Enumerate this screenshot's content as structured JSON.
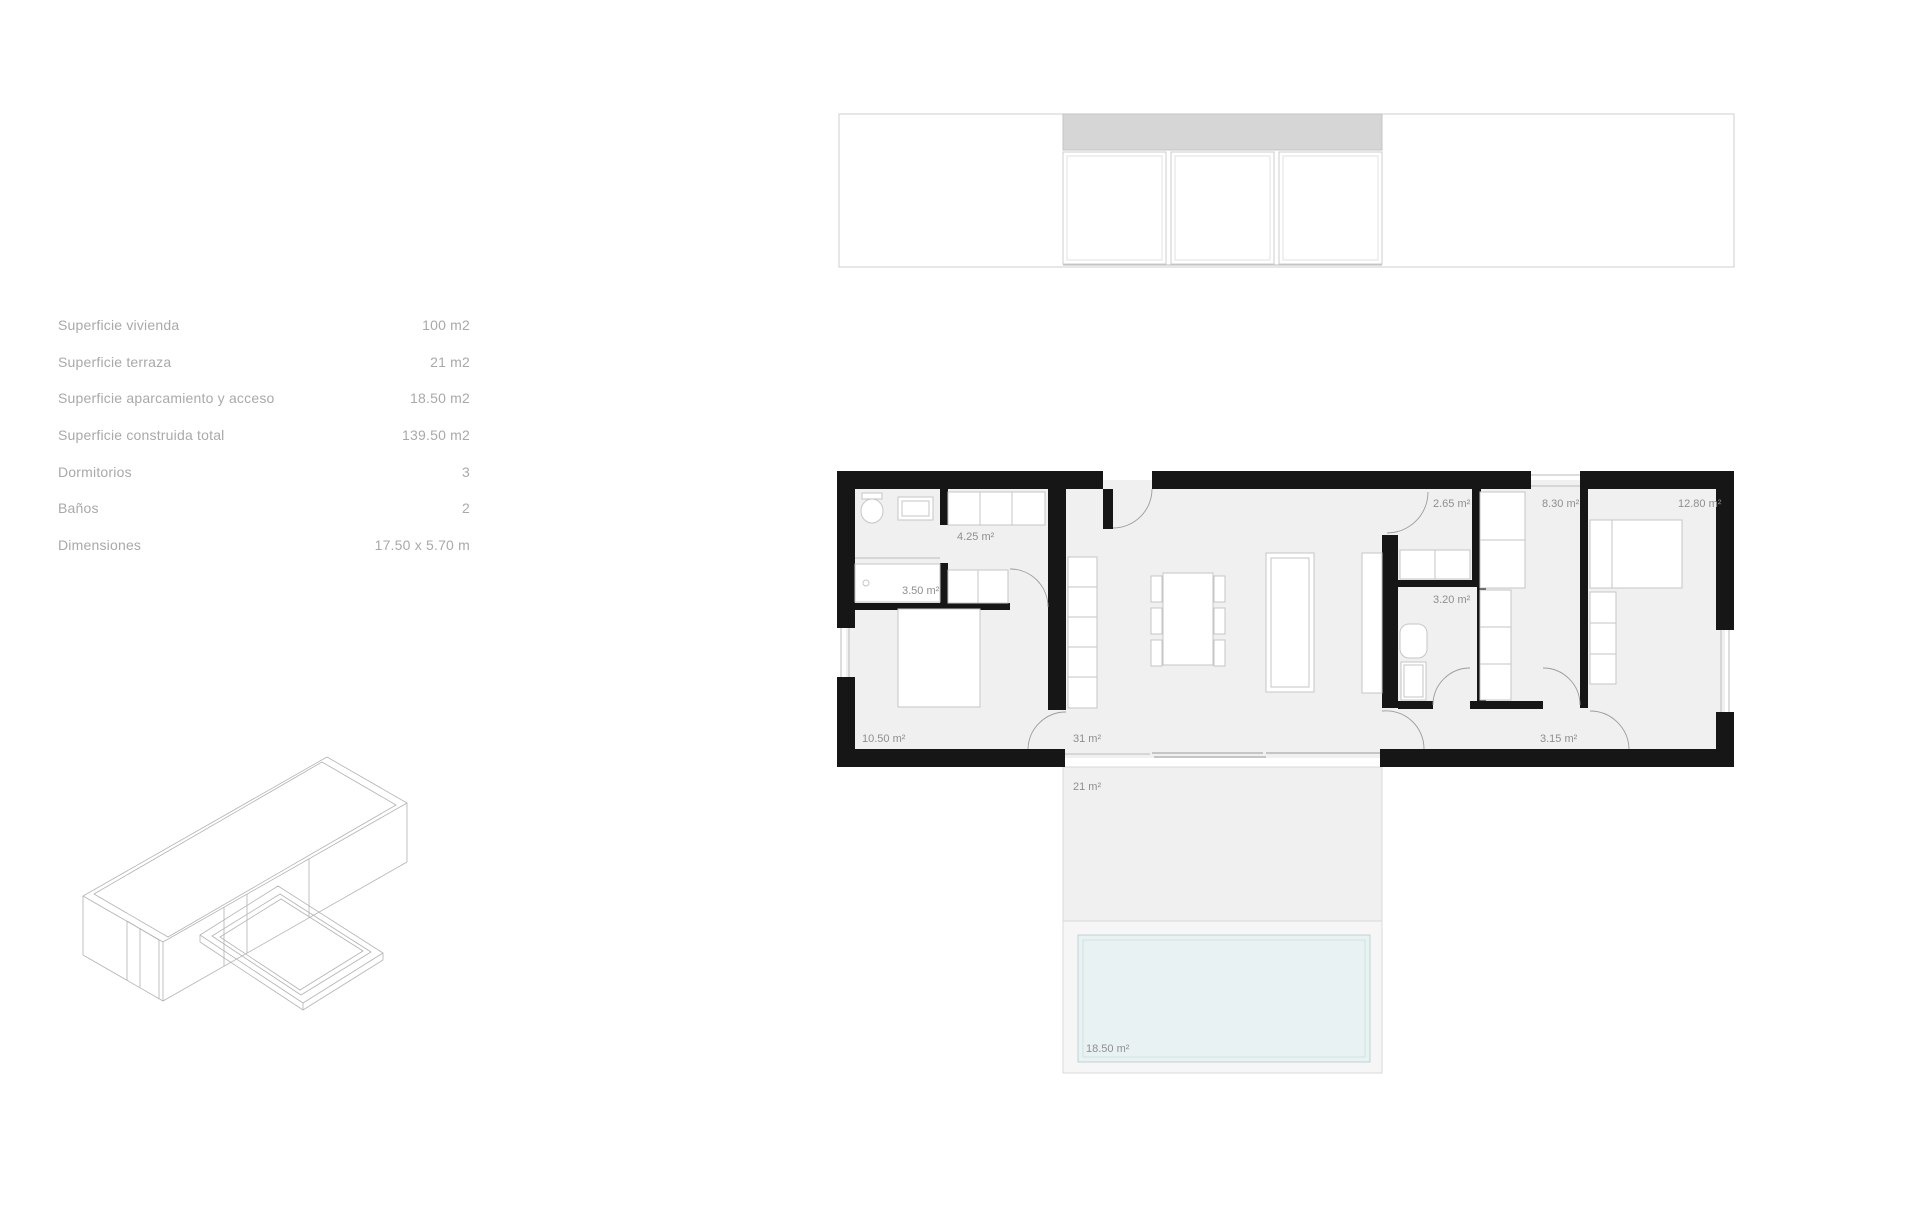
{
  "specs": {
    "rows": [
      {
        "label": "Superficie vivienda",
        "value": "100 m2"
      },
      {
        "label": "Superficie terraza",
        "value": "21 m2"
      },
      {
        "label": "Superficie aparcamiento y acceso",
        "value": "18.50 m2"
      },
      {
        "label": "Superficie construida total",
        "value": "139.50 m2"
      },
      {
        "label": "Dormitorios",
        "value": "3"
      },
      {
        "label": "Baños",
        "value": "2"
      },
      {
        "label": "Dimensiones",
        "value": "17.50 x 5.70 m"
      }
    ]
  },
  "plan": {
    "labels": [
      {
        "id": "wardrobe",
        "text": "4.25 m²"
      },
      {
        "id": "bath-1",
        "text": "3.50 m²"
      },
      {
        "id": "bedroom-1",
        "text": "10.50 m²"
      },
      {
        "id": "living",
        "text": "31 m²"
      },
      {
        "id": "terrace",
        "text": "21 m²"
      },
      {
        "id": "aseo",
        "text": "2.65 m²"
      },
      {
        "id": "dressing",
        "text": "8.30 m²"
      },
      {
        "id": "bedroom-2",
        "text": "12.80 m²"
      },
      {
        "id": "bath-2",
        "text": "3.20 m²"
      },
      {
        "id": "hallway",
        "text": "3.15 m²"
      },
      {
        "id": "pool",
        "text": "18.50 m²"
      }
    ]
  },
  "colors": {
    "wall": "#161616",
    "floor": "#f0f0f0",
    "band": "#d6d6d6",
    "pool": "#e9f2f2",
    "poolline": "#bdd1d3",
    "label": "#8f8f8f",
    "tabletext": "#a9a9a9"
  }
}
